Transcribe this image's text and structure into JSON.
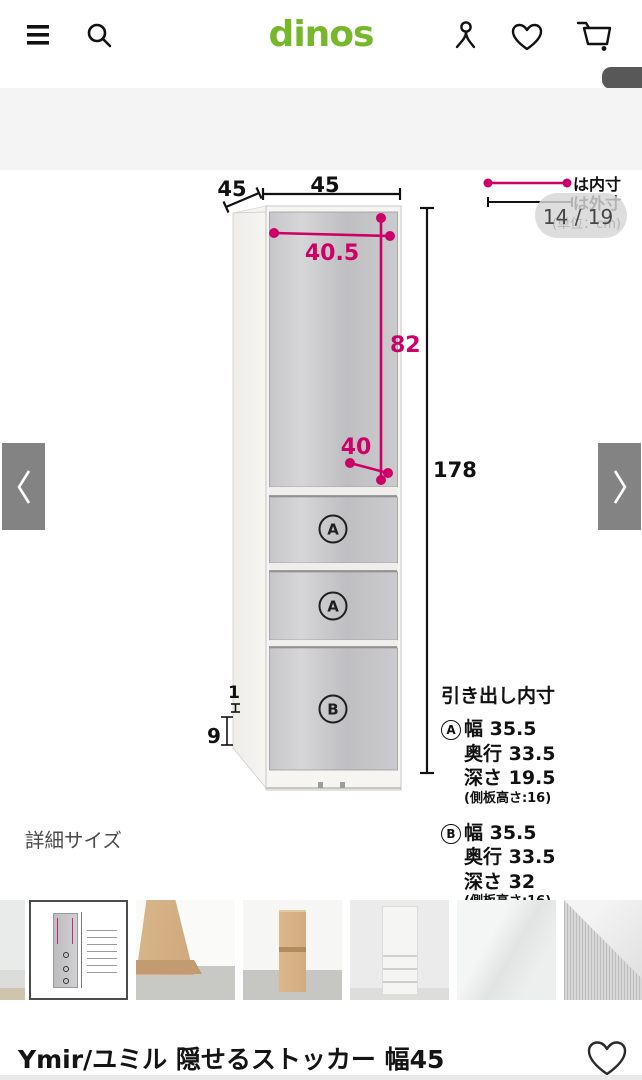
{
  "colors": {
    "accent_magenta": "#cc0067",
    "logo_green": "#76b82a",
    "link_blue": "#1b4f9c"
  },
  "header": {
    "logo": "dinos"
  },
  "breadcrumb": {
    "category": "ー/隙間収納",
    "separator": ">",
    "current": "Ymir/ユミル 隠せるストッカー 幅45奥行45cm高さ178cm"
  },
  "carousel": {
    "page_badge": "14 / 19"
  },
  "diagram": {
    "legend": {
      "inner_label": "は内寸",
      "outer_label": "は外寸",
      "unit_note": "(単位：cm)"
    },
    "outer": {
      "depth": "45",
      "width": "45",
      "height": "178",
      "base_height": "9",
      "toe_kick": "1"
    },
    "inner": {
      "door_width": "40.5",
      "door_height": "82",
      "bottom_depth": "40"
    },
    "drawers": {
      "a_letter": "A",
      "b_letter": "B"
    },
    "specs": {
      "title": "引き出し内寸",
      "a": {
        "letter": "A",
        "width": "幅 35.5",
        "depth": "奥行 33.5",
        "drawer_depth": "深さ 19.5",
        "note": "(側板高さ:16)"
      },
      "b": {
        "letter": "B",
        "width": "幅 35.5",
        "depth": "奥行 33.5",
        "drawer_depth": "深さ 32",
        "note": "(側板高さ:16)"
      }
    }
  },
  "section": {
    "title": "詳細サイズ"
  },
  "product": {
    "title": "Ymir/ユミル 隠せるストッカー 幅45"
  }
}
